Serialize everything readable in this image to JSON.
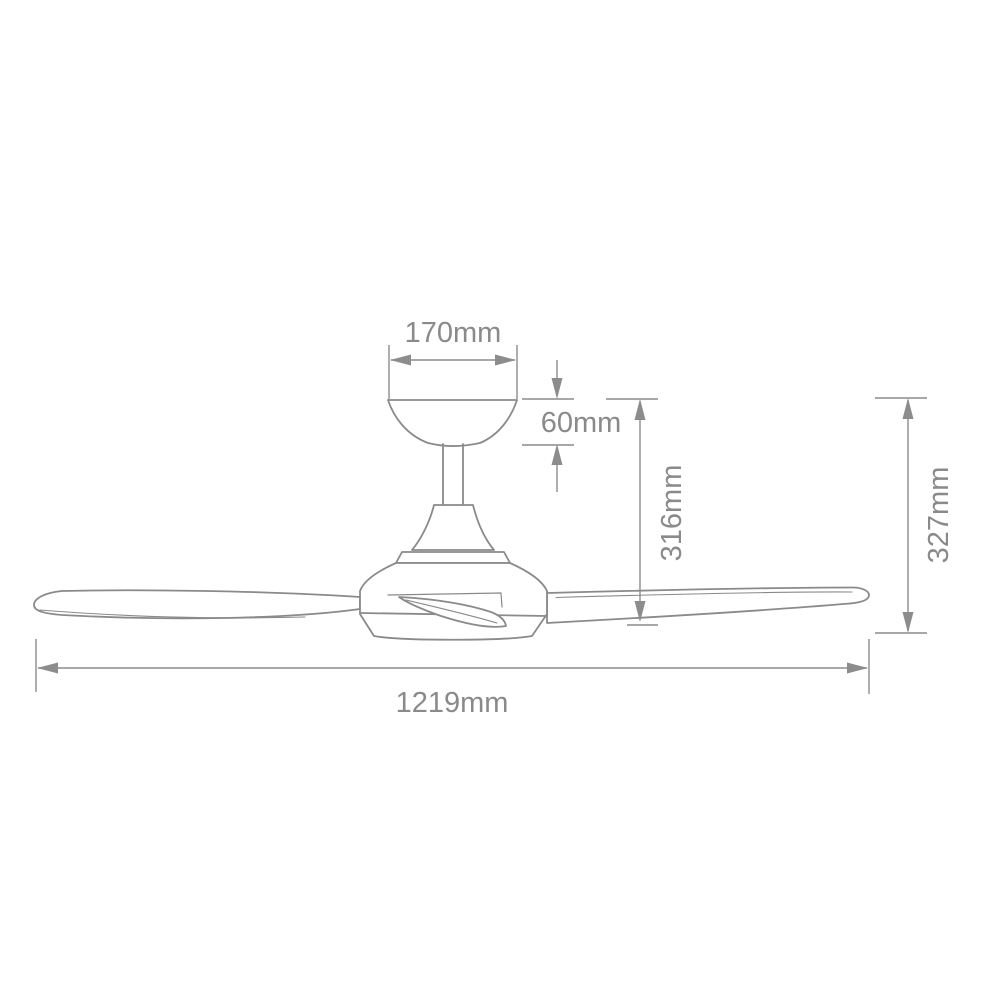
{
  "diagram": {
    "colors": {
      "background": "#ffffff",
      "line": "#8a8a8a",
      "text": "#8a8a8a"
    },
    "dimensions": {
      "canopy_width": {
        "label": "170mm"
      },
      "canopy_height": {
        "label": "60mm"
      },
      "top_to_blade_height": {
        "label": "316mm"
      },
      "overall_height": {
        "label": "327mm"
      },
      "blade_span": {
        "label": "1219mm"
      }
    }
  }
}
